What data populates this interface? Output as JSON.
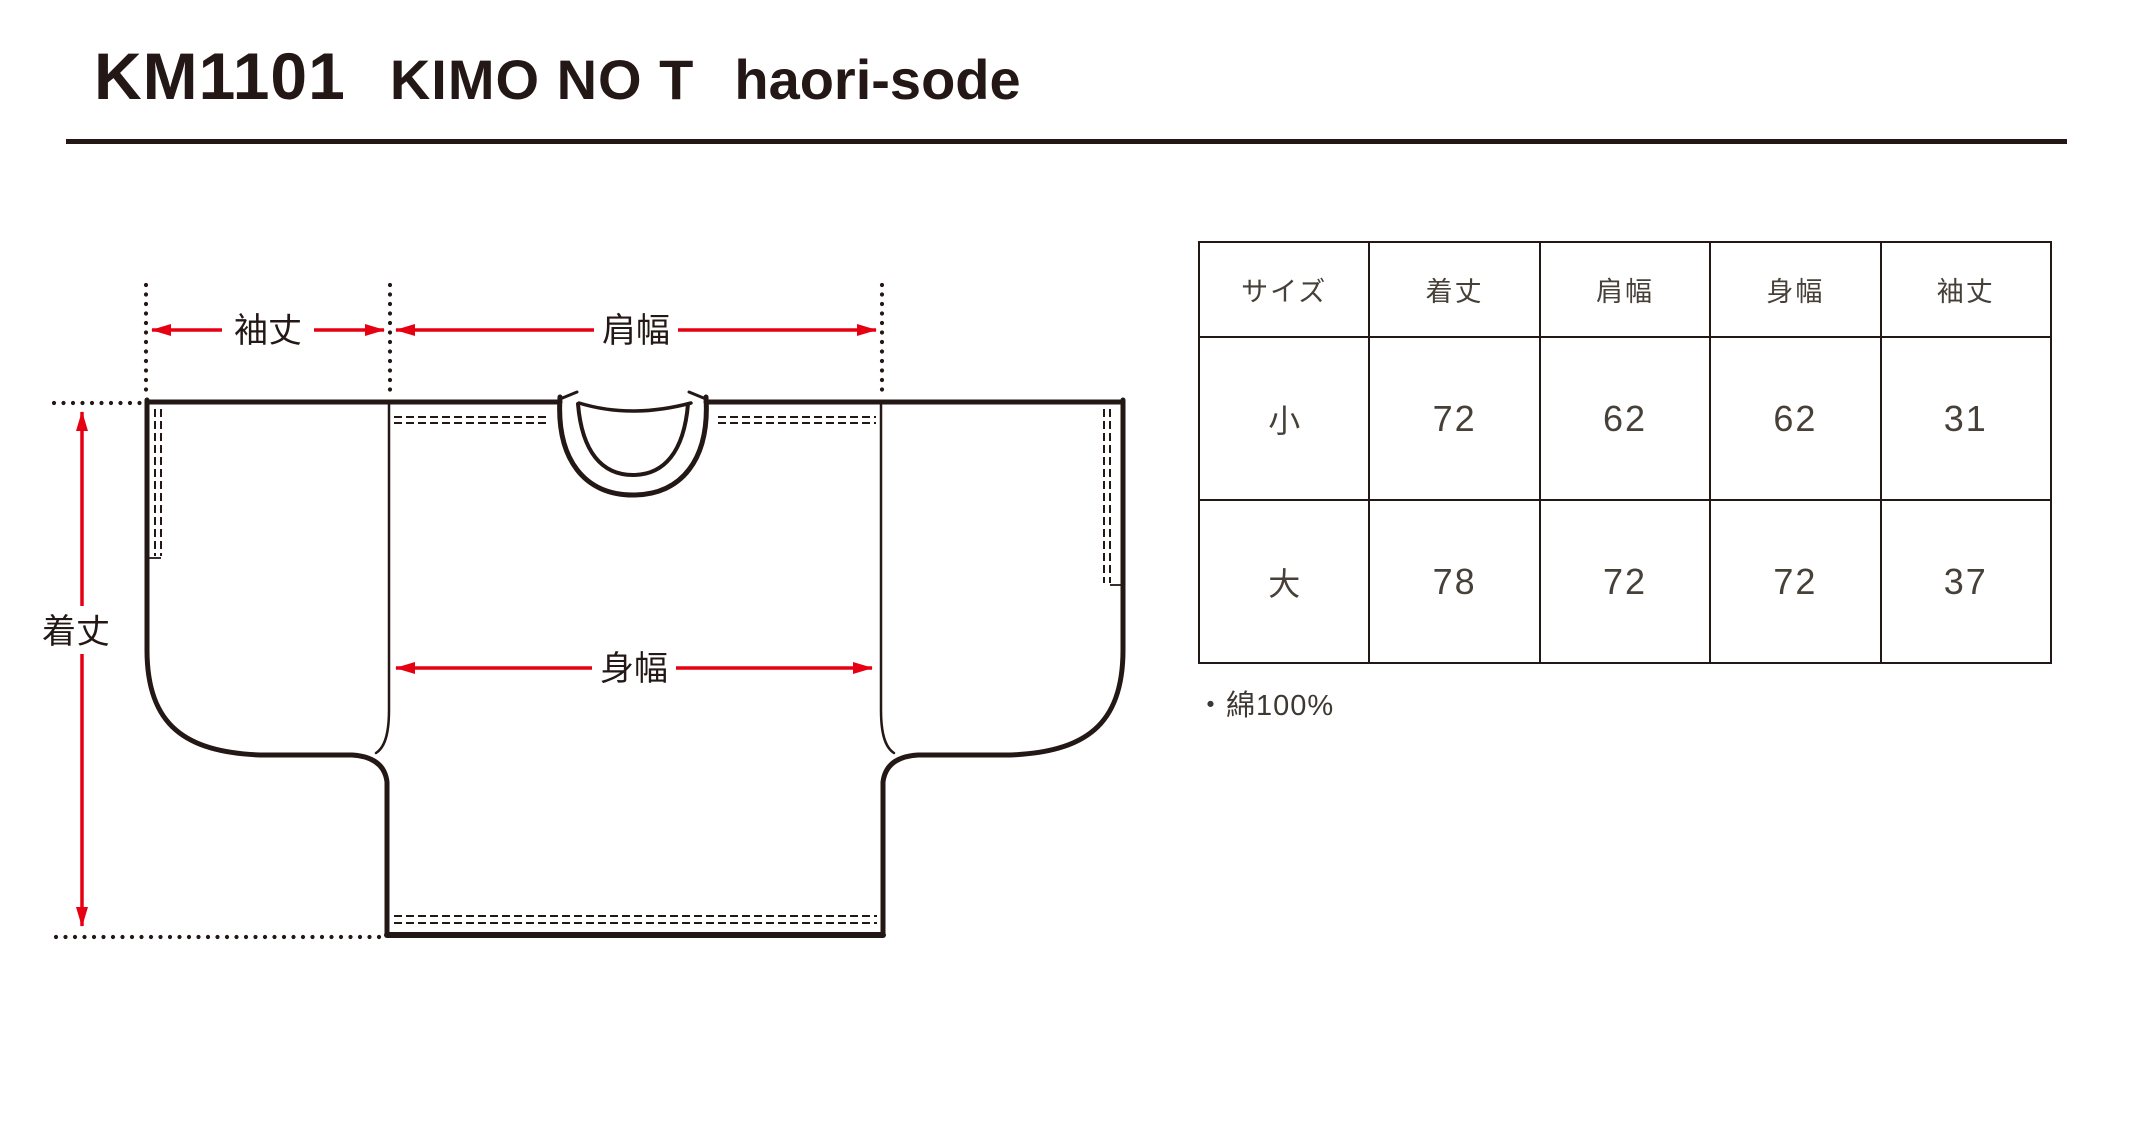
{
  "header": {
    "product_code": "KM1101",
    "product_name": "KIMO NO T",
    "product_subname": "haori-sode"
  },
  "diagram": {
    "labels": {
      "sleeve_length": "袖丈",
      "shoulder_width": "肩幅",
      "body_width": "身幅",
      "body_length": "着丈"
    }
  },
  "size_table": {
    "headers": [
      "サイズ",
      "着丈",
      "肩幅",
      "身幅",
      "袖丈"
    ],
    "rows": [
      {
        "size": "小",
        "values": [
          "72",
          "62",
          "62",
          "31"
        ]
      },
      {
        "size": "大",
        "values": [
          "78",
          "72",
          "72",
          "37"
        ]
      }
    ]
  },
  "material_note": "・綿100%",
  "colors": {
    "ink": "#231815",
    "accent_red": "#e60012",
    "background": "#ffffff"
  }
}
